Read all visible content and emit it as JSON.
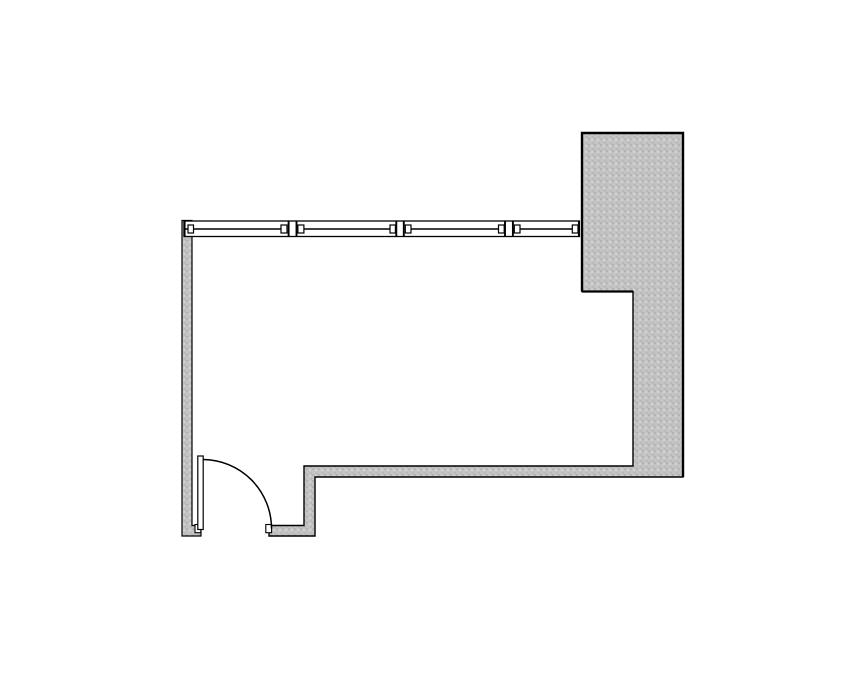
{
  "canvas": {
    "width": 855,
    "height": 678,
    "background": "#ffffff"
  },
  "palette": {
    "line": "#000000",
    "wall_base": "#c4c3c3",
    "window_fill": "#ffffff",
    "speckles": [
      {
        "color": "#b4b4b4",
        "x": 0,
        "y": 0
      },
      {
        "color": "#d4d4d4",
        "x": 3,
        "y": 1
      },
      {
        "color": "#ccbecc",
        "x": 1,
        "y": 3
      },
      {
        "color": "#b2c1af",
        "x": 4,
        "y": 4
      }
    ]
  },
  "floorplan": {
    "walls": [
      {
        "name": "left-wall",
        "stroke_width": 1.2,
        "points": [
          [
            182,
            220.5
          ],
          [
            192,
            220.5
          ],
          [
            192,
            525.5
          ],
          [
            201,
            525.5
          ],
          [
            201,
            536
          ],
          [
            182,
            536
          ]
        ]
      },
      {
        "name": "right-wall-and-column",
        "stroke_width": 1.4,
        "points": [
          [
            582,
            133
          ],
          [
            683,
            133
          ],
          [
            683,
            477
          ],
          [
            315,
            477
          ],
          [
            315,
            536
          ],
          [
            269,
            536
          ],
          [
            269,
            525.5
          ],
          [
            304,
            525.5
          ],
          [
            304,
            466
          ],
          [
            633,
            466
          ],
          [
            633,
            291.5
          ],
          [
            582,
            291.5
          ]
        ]
      }
    ],
    "emphasis_edges": [
      {
        "name": "column-heavy-border",
        "d": "M 582 291.5 L 582 133 L 683 133 L 683 477",
        "width": 2.4
      },
      {
        "name": "column-bottom-edge",
        "d": "M 582 291.5 L 633 291.5",
        "width": 2.2
      }
    ],
    "window_band": {
      "name": "window-band",
      "outline": {
        "x": 184,
        "y": 221,
        "w": 395.4,
        "h": 15.5
      },
      "stroke_width": 1.3,
      "glass_y": 229,
      "glass_width": 1.5,
      "glass_segments": [
        [
          185.2,
          287.5
        ],
        [
          297.7,
          395.5
        ],
        [
          405,
          504.2
        ],
        [
          514,
          578.2
        ]
      ],
      "vertical_lines": [
        184.6,
        288.6,
        296.5,
        396.3,
        403.8,
        505,
        512.9,
        578.9
      ],
      "vline_width": 1.9,
      "squares": {
        "xs": [
          [
            188,
            193.5
          ],
          [
            281,
            287
          ],
          [
            297.9,
            303.9
          ],
          [
            390,
            395.4
          ],
          [
            405.3,
            411
          ],
          [
            498.5,
            504.2
          ],
          [
            514.3,
            520
          ],
          [
            572.3,
            578
          ]
        ],
        "y": 225,
        "h": 8
      }
    },
    "door": {
      "name": "door",
      "stops": [
        {
          "x": 195,
          "y": 524.5,
          "w": 5.8,
          "h": 8.2
        },
        {
          "x": 265.8,
          "y": 524.5,
          "w": 5.8,
          "h": 8.2
        }
      ],
      "leaf": {
        "x": 197.8,
        "y": 456,
        "w": 5.4,
        "h": 73.5
      },
      "arc": {
        "d": "M 203.2 459.5 A 69 69 0 0 1 271.5 528.5",
        "width": 1.5
      }
    }
  }
}
